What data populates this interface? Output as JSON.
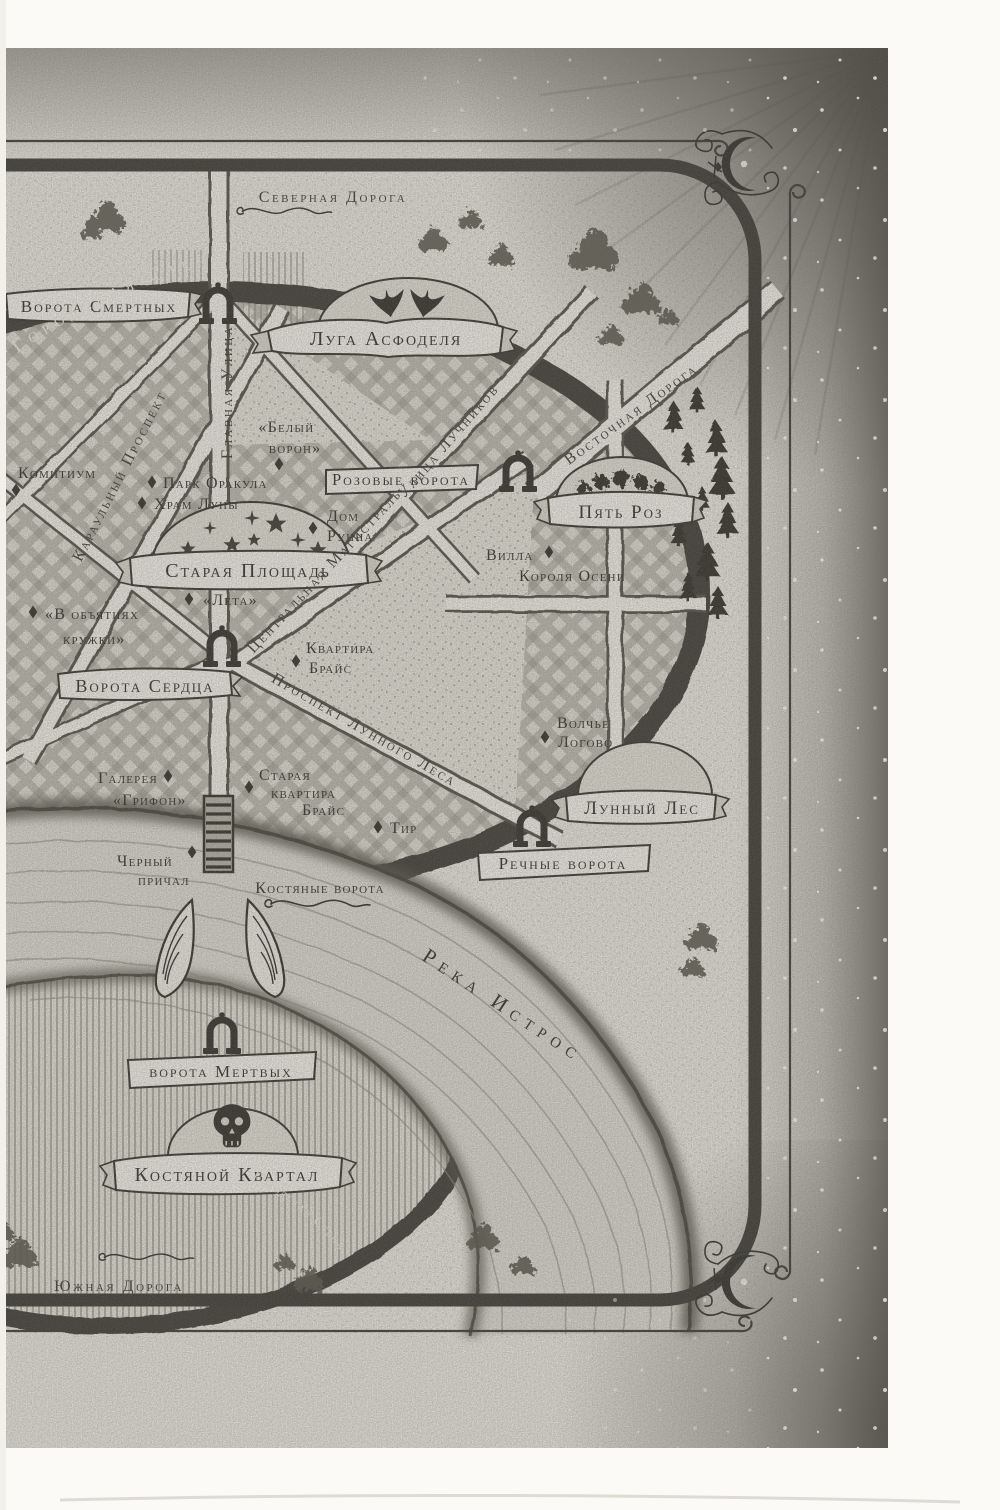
{
  "colors": {
    "ink": "#2f2e28",
    "paper": "#e9e7df",
    "road_fill": "#f0efe8",
    "wall": "#3c3b34",
    "river": "#dcdad2",
    "margin_shade": "#55534a"
  },
  "roads": {
    "north": "Северная Дорога",
    "south": "Южная Дорога",
    "east": "Восточная Дорога",
    "main_street": "Главная Улица",
    "guard_avenue": "Караульный Проспект",
    "archers_street": "Улица Лучников",
    "central_highway": "Центральная Магистраль",
    "moonwood_avenue": "Проспект Лунного Леса"
  },
  "walls": {
    "city_wall_north": "Городская Стена",
    "city_wall_south": "Городская Стена"
  },
  "river": {
    "name": "Река Истрос"
  },
  "districts": {
    "asphodel_meadows": "Луга Асфоделя",
    "five_roses": "Пять Роз",
    "old_square": "Старая Площадь",
    "moonwood": "Лунный Лес",
    "bone_quarter": "Костяной Квартал"
  },
  "gates": {
    "mortal_gate": "Ворота Смертных",
    "rose_gate": "Розовые ворота",
    "heart_gate": "Ворота Сердца",
    "river_gate": "Речные ворота",
    "dead_gate": "ворота Мертвых",
    "bone_gate": "Костяные ворота"
  },
  "places": {
    "comitium": "Комитиум",
    "white_raven_l1": "«Белый",
    "white_raven_l2": "ворон»",
    "oracle_park": "Парк Оракула",
    "moon_temple": "Храм Луны",
    "runn_house_l1": "Дом",
    "runn_house_l2": "Рунна",
    "autumn_king_villa_l1": "Вилла",
    "autumn_king_villa_l2": "Короля Осени",
    "lethe": "«Лета»",
    "mug_embrace_l1": "«В объятиях",
    "mug_embrace_l2": "кружки»",
    "bryce_apartment_l1": "Квартира",
    "bryce_apartment_l2": "Брайс",
    "wolf_den_l1": "Волчье",
    "wolf_den_l2": "Логово",
    "griffin_gallery_l1": "Галерея",
    "griffin_gallery_l2": "«Грифон»",
    "bryce_old_apartment_l1": "Старая",
    "bryce_old_apartment_l2": "квартира",
    "bryce_old_apartment_l3": "Брайс",
    "shooting_range": "Тир",
    "black_dock_l1": "Черный",
    "black_dock_l2": "причал"
  },
  "icons": {
    "asphodel_meadows": "asphodel-flowers-icon",
    "five_roses": "roses-icon",
    "old_square": "star-dome-icon",
    "moonwood": "crescent-moon-icon",
    "bone_quarter": "skull-icon",
    "gate": "gate-arch-icon",
    "bone_gate": "winged-gate-icon",
    "marker": "diamond-marker",
    "corner": "crescent-flourish-ornament"
  }
}
